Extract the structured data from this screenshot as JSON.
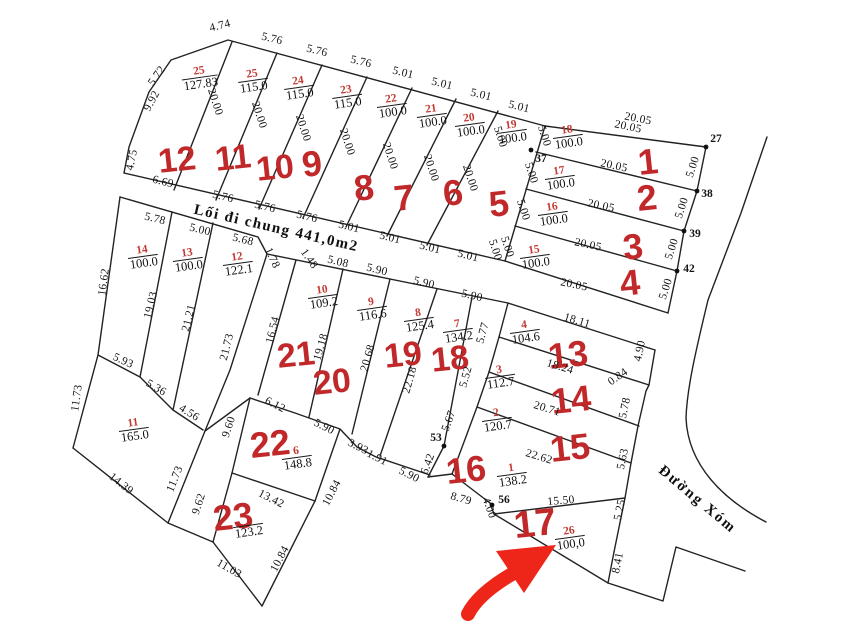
{
  "canvas": {
    "width": 842,
    "height": 634,
    "background": "#ffffff"
  },
  "colors": {
    "line": "#222222",
    "dimension_text": "#141414",
    "parcel_number_red": "#c23a33",
    "lot_number_red": "#c1282a",
    "arrow_red": "#ee2519"
  },
  "texts": {
    "common_path_label": "Lối đi chung 441,0m2",
    "road_label": "Đường Xóm"
  },
  "parcels": [
    {
      "n": "25",
      "a": "127.83",
      "x": 200,
      "y": 78
    },
    {
      "n": "25",
      "a": "115.0",
      "x": 253,
      "y": 81
    },
    {
      "n": "24",
      "a": "115.0",
      "x": 299,
      "y": 88
    },
    {
      "n": "23",
      "a": "115.0",
      "x": 347,
      "y": 97
    },
    {
      "n": "22",
      "a": "100.0",
      "x": 392,
      "y": 106
    },
    {
      "n": "21",
      "a": "100.0",
      "x": 432,
      "y": 116
    },
    {
      "n": "20",
      "a": "100.0",
      "x": 470,
      "y": 125
    },
    {
      "n": "19",
      "a": "100.0",
      "x": 512,
      "y": 132
    },
    {
      "n": "18",
      "a": "100.0",
      "x": 568,
      "y": 137
    },
    {
      "n": "17",
      "a": "100.0",
      "x": 560,
      "y": 178
    },
    {
      "n": "16",
      "a": "100.0",
      "x": 553,
      "y": 214
    },
    {
      "n": "15",
      "a": "100.0",
      "x": 535,
      "y": 257
    },
    {
      "n": "14",
      "a": "100.0",
      "x": 143,
      "y": 257
    },
    {
      "n": "13",
      "a": "100.0",
      "x": 188,
      "y": 260
    },
    {
      "n": "12",
      "a": "122.1",
      "x": 238,
      "y": 264
    },
    {
      "n": "10",
      "a": "109.2",
      "x": 323,
      "y": 297
    },
    {
      "n": "9",
      "a": "116.6",
      "x": 372,
      "y": 309
    },
    {
      "n": "8",
      "a": "125.4",
      "x": 419,
      "y": 320
    },
    {
      "n": "7",
      "a": "134.2",
      "x": 458,
      "y": 331
    },
    {
      "n": "4",
      "a": "104.6",
      "x": 525,
      "y": 332
    },
    {
      "n": "3",
      "a": "112.7",
      "x": 500,
      "y": 377
    },
    {
      "n": "2",
      "a": "120.7",
      "x": 497,
      "y": 420
    },
    {
      "n": "1",
      "a": "138.2",
      "x": 512,
      "y": 475
    },
    {
      "n": "11",
      "a": "165.0",
      "x": 134,
      "y": 430
    },
    {
      "n": "6",
      "a": "148.8",
      "x": 297,
      "y": 458
    },
    {
      "n": "26",
      "a": "100,0",
      "x": 570,
      "y": 538
    },
    {
      "n": "",
      "a": "123.2",
      "x": 249,
      "y": 532
    }
  ],
  "lot_numbers": [
    {
      "n": "12",
      "x": 177,
      "y": 160,
      "s": 34
    },
    {
      "n": "11",
      "x": 233,
      "y": 158,
      "s": 34
    },
    {
      "n": "10",
      "x": 275,
      "y": 168,
      "s": 34
    },
    {
      "n": "9",
      "x": 312,
      "y": 164,
      "s": 36
    },
    {
      "n": "8",
      "x": 364,
      "y": 188,
      "s": 36
    },
    {
      "n": "7",
      "x": 404,
      "y": 198,
      "s": 36
    },
    {
      "n": "6",
      "x": 453,
      "y": 193,
      "s": 36
    },
    {
      "n": "5",
      "x": 499,
      "y": 204,
      "s": 36
    },
    {
      "n": "1",
      "x": 648,
      "y": 162,
      "s": 36
    },
    {
      "n": "2",
      "x": 647,
      "y": 198,
      "s": 36
    },
    {
      "n": "3",
      "x": 633,
      "y": 247,
      "s": 36
    },
    {
      "n": "4",
      "x": 630,
      "y": 283,
      "s": 36
    },
    {
      "n": "13",
      "x": 568,
      "y": 355,
      "s": 36
    },
    {
      "n": "14",
      "x": 571,
      "y": 400,
      "s": 36
    },
    {
      "n": "15",
      "x": 570,
      "y": 448,
      "s": 36
    },
    {
      "n": "16",
      "x": 466,
      "y": 470,
      "s": 36
    },
    {
      "n": "17",
      "x": 535,
      "y": 524,
      "s": 38
    },
    {
      "n": "18",
      "x": 450,
      "y": 359,
      "s": 34
    },
    {
      "n": "19",
      "x": 403,
      "y": 355,
      "s": 34
    },
    {
      "n": "20",
      "x": 332,
      "y": 382,
      "s": 34
    },
    {
      "n": "21",
      "x": 296,
      "y": 355,
      "s": 34
    },
    {
      "n": "22",
      "x": 270,
      "y": 444,
      "s": 36
    },
    {
      "n": "23",
      "x": 233,
      "y": 517,
      "s": 36
    }
  ],
  "dimensions": [
    {
      "t": "4.74",
      "x": 220,
      "y": 26,
      "r": -14
    },
    {
      "t": "5.76",
      "x": 272,
      "y": 39,
      "r": 14
    },
    {
      "t": "5.76",
      "x": 317,
      "y": 51,
      "r": 14
    },
    {
      "t": "5.76",
      "x": 361,
      "y": 62,
      "r": 14
    },
    {
      "t": "5.01",
      "x": 403,
      "y": 73,
      "r": 14
    },
    {
      "t": "5.01",
      "x": 442,
      "y": 84,
      "r": 14
    },
    {
      "t": "5.01",
      "x": 481,
      "y": 95,
      "r": 14
    },
    {
      "t": "5.01",
      "x": 519,
      "y": 107,
      "r": 14
    },
    {
      "t": "20.05",
      "x": 638,
      "y": 119,
      "r": 11
    },
    {
      "t": "5.72",
      "x": 157,
      "y": 76,
      "r": -55
    },
    {
      "t": "9.92",
      "x": 152,
      "y": 101,
      "r": -62
    },
    {
      "t": "4.75",
      "x": 132,
      "y": 160,
      "r": -78
    },
    {
      "t": "6.69",
      "x": 163,
      "y": 182,
      "r": 14
    },
    {
      "t": "20.00",
      "x": 215,
      "y": 102,
      "r": 72
    },
    {
      "t": "20.00",
      "x": 259,
      "y": 115,
      "r": 72
    },
    {
      "t": "20.00",
      "x": 303,
      "y": 128,
      "r": 72
    },
    {
      "t": "20.00",
      "x": 347,
      "y": 142,
      "r": 72
    },
    {
      "t": "20.00",
      "x": 390,
      "y": 156,
      "r": 72
    },
    {
      "t": "20.00",
      "x": 431,
      "y": 168,
      "r": 72
    },
    {
      "t": "20.00",
      "x": 470,
      "y": 178,
      "r": 72
    },
    {
      "t": "5.76",
      "x": 223,
      "y": 197,
      "r": 14
    },
    {
      "t": "5.76",
      "x": 265,
      "y": 207,
      "r": 14
    },
    {
      "t": "5.76",
      "x": 307,
      "y": 217,
      "r": 14
    },
    {
      "t": "5.01",
      "x": 349,
      "y": 227,
      "r": 14
    },
    {
      "t": "5.01",
      "x": 390,
      "y": 238,
      "r": 14
    },
    {
      "t": "5.01",
      "x": 430,
      "y": 248,
      "r": 14
    },
    {
      "t": "5.01",
      "x": 468,
      "y": 256,
      "r": 14
    },
    {
      "t": "5.00",
      "x": 495,
      "y": 250,
      "r": 72
    },
    {
      "t": "5.00",
      "x": 500,
      "y": 137,
      "r": 72
    },
    {
      "t": "5.00",
      "x": 544,
      "y": 136,
      "r": 72
    },
    {
      "t": "5.00",
      "x": 531,
      "y": 173,
      "r": 72
    },
    {
      "t": "5.00",
      "x": 523,
      "y": 210,
      "r": 72
    },
    {
      "t": "5.00",
      "x": 507,
      "y": 247,
      "r": 72
    },
    {
      "t": "5.00",
      "x": 693,
      "y": 167,
      "r": -72
    },
    {
      "t": "5.00",
      "x": 682,
      "y": 208,
      "r": -72
    },
    {
      "t": "5.00",
      "x": 672,
      "y": 249,
      "r": -72
    },
    {
      "t": "5.00",
      "x": 666,
      "y": 289,
      "r": -72
    },
    {
      "t": "20.05",
      "x": 628,
      "y": 127,
      "r": 12
    },
    {
      "t": "20.05",
      "x": 614,
      "y": 166,
      "r": 12
    },
    {
      "t": "20.05",
      "x": 601,
      "y": 206,
      "r": 12
    },
    {
      "t": "20.05",
      "x": 588,
      "y": 245,
      "r": 12
    },
    {
      "t": "20.05",
      "x": 574,
      "y": 285,
      "r": 12
    },
    {
      "t": "18.11",
      "x": 577,
      "y": 321,
      "r": 17
    },
    {
      "t": "5.78",
      "x": 155,
      "y": 219,
      "r": 14
    },
    {
      "t": "5.00",
      "x": 200,
      "y": 230,
      "r": 14
    },
    {
      "t": "5.68",
      "x": 243,
      "y": 240,
      "r": 14
    },
    {
      "t": "1.78",
      "x": 272,
      "y": 258,
      "r": 65
    },
    {
      "t": "1.48",
      "x": 309,
      "y": 259,
      "r": 55
    },
    {
      "t": "5.08",
      "x": 338,
      "y": 262,
      "r": 14
    },
    {
      "t": "5.90",
      "x": 377,
      "y": 270,
      "r": 14
    },
    {
      "t": "5.90",
      "x": 424,
      "y": 283,
      "r": 14
    },
    {
      "t": "5.90",
      "x": 472,
      "y": 296,
      "r": 14
    },
    {
      "t": "16.62",
      "x": 104,
      "y": 282,
      "r": -82
    },
    {
      "t": "19.03",
      "x": 151,
      "y": 305,
      "r": -76
    },
    {
      "t": "21.21",
      "x": 189,
      "y": 318,
      "r": -76
    },
    {
      "t": "21.73",
      "x": 227,
      "y": 347,
      "r": -76
    },
    {
      "t": "16.54",
      "x": 273,
      "y": 330,
      "r": -76
    },
    {
      "t": "19.18",
      "x": 321,
      "y": 347,
      "r": -74
    },
    {
      "t": "20.68",
      "x": 368,
      "y": 358,
      "r": -74
    },
    {
      "t": "22.18",
      "x": 410,
      "y": 380,
      "r": -74
    },
    {
      "t": "5.93",
      "x": 123,
      "y": 361,
      "r": 25
    },
    {
      "t": "5.36",
      "x": 156,
      "y": 388,
      "r": 30
    },
    {
      "t": "4.56",
      "x": 189,
      "y": 413,
      "r": 32
    },
    {
      "t": "11.73",
      "x": 77,
      "y": 398,
      "r": -82
    },
    {
      "t": "14.39",
      "x": 121,
      "y": 484,
      "r": 38
    },
    {
      "t": "11.73",
      "x": 175,
      "y": 479,
      "r": -68
    },
    {
      "t": "9.60",
      "x": 229,
      "y": 427,
      "r": -72
    },
    {
      "t": "9.62",
      "x": 199,
      "y": 504,
      "r": -72
    },
    {
      "t": "6.12",
      "x": 275,
      "y": 405,
      "r": 27
    },
    {
      "t": "5.90",
      "x": 324,
      "y": 427,
      "r": 27
    },
    {
      "t": "13.42",
      "x": 271,
      "y": 499,
      "r": 27
    },
    {
      "t": "10.84",
      "x": 332,
      "y": 493,
      "r": -62
    },
    {
      "t": "10.84",
      "x": 280,
      "y": 559,
      "r": -62
    },
    {
      "t": "11.03",
      "x": 229,
      "y": 569,
      "r": 30
    },
    {
      "t": "3.93",
      "x": 358,
      "y": 447,
      "r": 27
    },
    {
      "t": "1.91",
      "x": 377,
      "y": 458,
      "r": 27
    },
    {
      "t": "5.90",
      "x": 409,
      "y": 475,
      "r": 27
    },
    {
      "t": "6.42",
      "x": 428,
      "y": 464,
      "r": -70
    },
    {
      "t": "5.67",
      "x": 449,
      "y": 421,
      "r": -70
    },
    {
      "t": "18.24",
      "x": 560,
      "y": 367,
      "r": 17
    },
    {
      "t": "20.71",
      "x": 547,
      "y": 409,
      "r": 17
    },
    {
      "t": "22.62",
      "x": 539,
      "y": 457,
      "r": 17
    },
    {
      "t": "15.50",
      "x": 561,
      "y": 501,
      "r": -5
    },
    {
      "t": "8.79",
      "x": 461,
      "y": 499,
      "r": 16
    },
    {
      "t": "4.00",
      "x": 489,
      "y": 508,
      "r": 70
    },
    {
      "t": "5.77",
      "x": 483,
      "y": 333,
      "r": -74
    },
    {
      "t": "5.52",
      "x": 466,
      "y": 377,
      "r": -74
    },
    {
      "t": "4.90",
      "x": 640,
      "y": 351,
      "r": -78
    },
    {
      "t": "0.84",
      "x": 618,
      "y": 377,
      "r": -35
    },
    {
      "t": "5.78",
      "x": 625,
      "y": 408,
      "r": -78
    },
    {
      "t": "5.63",
      "x": 623,
      "y": 459,
      "r": -78
    },
    {
      "t": "5.25",
      "x": 620,
      "y": 510,
      "r": -78
    },
    {
      "t": "8.41",
      "x": 618,
      "y": 563,
      "r": -78
    }
  ],
  "point_labels": [
    {
      "t": "27",
      "x": 716,
      "y": 139
    },
    {
      "t": "37",
      "x": 541,
      "y": 159
    },
    {
      "t": "38",
      "x": 707,
      "y": 194
    },
    {
      "t": "39",
      "x": 695,
      "y": 234
    },
    {
      "t": "42",
      "x": 689,
      "y": 269
    },
    {
      "t": "53",
      "x": 436,
      "y": 438
    },
    {
      "t": "56",
      "x": 504,
      "y": 500
    }
  ]
}
